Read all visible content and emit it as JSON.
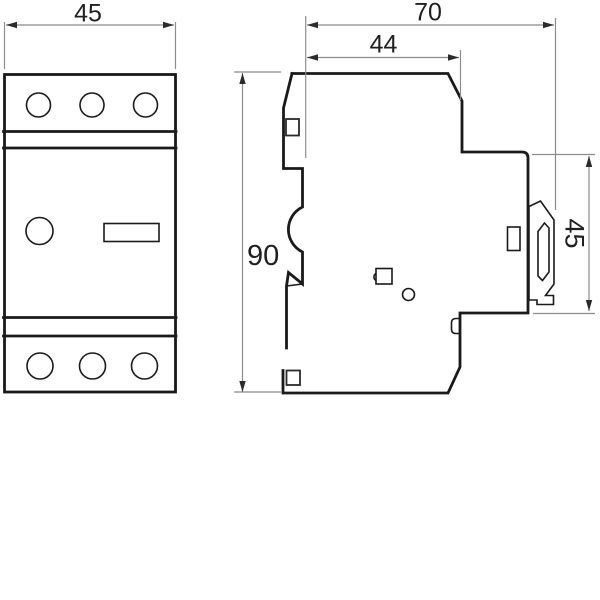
{
  "drawing": {
    "dims": {
      "front_width": "45",
      "overall_depth": "70",
      "upper_depth": "44",
      "overall_height": "90",
      "rail_height": "45"
    },
    "colors": {
      "outline": "#1a1a1a",
      "dimension_lines": "#8c8c8c",
      "dimension_text": "#1f1f1f",
      "background": "#ffffff"
    }
  }
}
